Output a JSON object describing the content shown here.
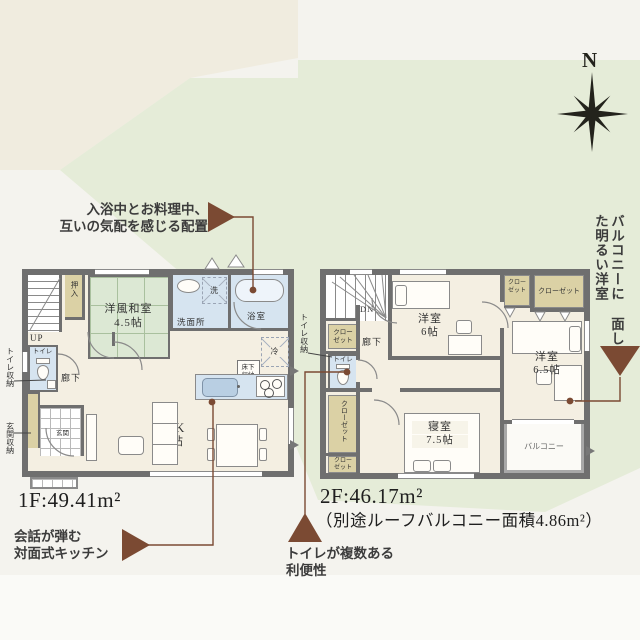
{
  "colors": {
    "accent_brown": "#7b4a33",
    "wall_gray": "#6f6f6f",
    "tatami_green": "#dce8d4",
    "wet_blue": "#d6e4f0",
    "closet_tan": "#dbd1a5",
    "bg_green": "#e5ecd8",
    "bg_cream": "#f0ecdf",
    "floor_cream": "#f4efe2"
  },
  "compass": {
    "north": "N"
  },
  "callouts": {
    "bath": {
      "line1": "入浴中とお料理中、",
      "line2": "互いの気配を感じる配置"
    },
    "balcony": {
      "col1": "バルコニーに",
      "col2": "面した明るい洋室"
    },
    "kitchen": {
      "line1": "会話が弾む",
      "line2": "対面式キッチン"
    },
    "toilet": {
      "line1": "トイレが複数ある",
      "line2": "利便性"
    }
  },
  "floor1": {
    "area": "1F:49.41m²",
    "labels": {
      "up": "UP",
      "hallway": "廊下",
      "entrance": "玄関",
      "oshiire": "押入",
      "tatami_name": "洋風和室",
      "tatami_size": "4.5帖",
      "washroom": "洗面所",
      "bath": "浴室",
      "toilet": "トイレ",
      "ldk_name": "LDK",
      "ldk_size": "16帖",
      "underfloor1": "床下",
      "underfloor2": "収納",
      "washer": "洗",
      "fridge": "冷",
      "toilet_storage": "トイレ収納",
      "entrance_storage": "玄関収納"
    }
  },
  "floor2": {
    "area": "2F:46.17m²",
    "area_note": "（別途ルーフバルコニー面積4.86m²）",
    "labels": {
      "dn": "DN",
      "hallway": "廊下",
      "toilet": "トイレ",
      "toilet_storage": "トイレ収納",
      "closet": "クローゼット",
      "closet_s1": "クロー",
      "closet_s2": "ゼット",
      "bed1_name": "洋室",
      "bed1_size": "6帖",
      "bed2_name": "洋室",
      "bed2_size": "6.5帖",
      "master_name": "寝室",
      "master_size": "7.5帖",
      "balcony": "バルコニー"
    }
  }
}
